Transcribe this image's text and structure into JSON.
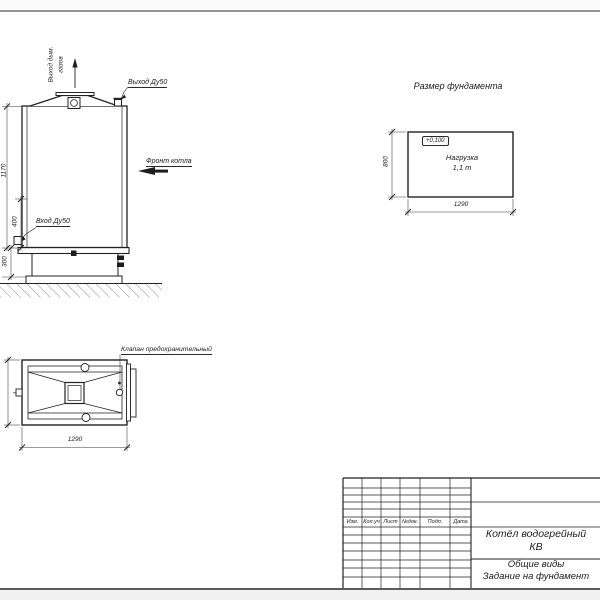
{
  "front_view": {
    "smoke_out_label_1": "Выход дым.",
    "smoke_out_label_2": "газов",
    "outlet_label": "Выход Ду50",
    "front_label": "Фронт котла",
    "inlet_label": "Вход Ду50",
    "dim_height": "1170",
    "dim_inlet": "400",
    "dim_base": "300"
  },
  "plan_view": {
    "valve_label": "Клапан предохранительный",
    "dim_width": "1290"
  },
  "foundation": {
    "title": "Размер фундамента",
    "elevation": "+0,100",
    "load_line1": "Нагрузка",
    "load_line2": "1,1 т",
    "dim_height": "800",
    "dim_width": "1290"
  },
  "title_block": {
    "columns": [
      "Изм.",
      "Кол.уч",
      "Лист",
      "№док.",
      "Подп.",
      "Дата"
    ],
    "name_line1": "Котёл водогрейный",
    "name_line2": "КВ",
    "doc_line1": "Общие виды",
    "doc_line2": "Задание на фундамент"
  }
}
